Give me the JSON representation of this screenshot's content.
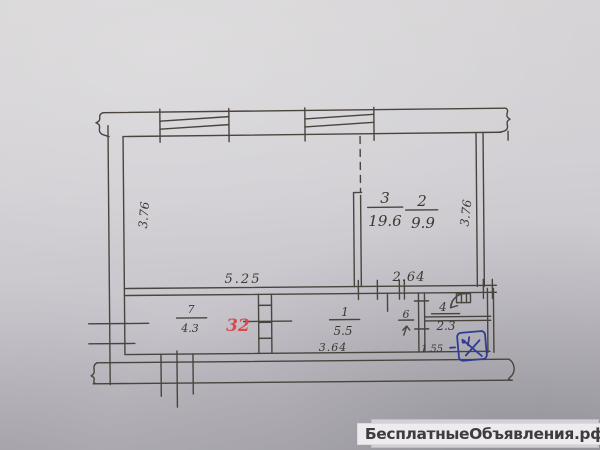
{
  "watermark": {
    "text": "БесплатныеОбъявления.рф"
  },
  "plan": {
    "note_red": "32",
    "rooms": {
      "r3": {
        "num": "3",
        "area": "19.6"
      },
      "r2": {
        "num": "2",
        "area": "9.9"
      },
      "r7": {
        "num": "7",
        "area": "4.3"
      },
      "r1": {
        "num": "1",
        "area": "5.5"
      },
      "r4": {
        "num": "4",
        "area": "2.3"
      },
      "r6": {
        "num": "6"
      }
    },
    "dims": {
      "left_height": "3.76",
      "right_height": "3.76",
      "room3_width": "5.25",
      "room2_width": "2.64",
      "hall_width": "3.64",
      "small_width": "1.55"
    },
    "icons": {
      "blue_stamp": "hand-drawn blue ink mark",
      "door_arc": "door swing",
      "vent_box": "ventilation shaft"
    },
    "stamp_color": "#2e3c96",
    "ink_color": "#4a443e",
    "red_color": "#d84a50"
  }
}
